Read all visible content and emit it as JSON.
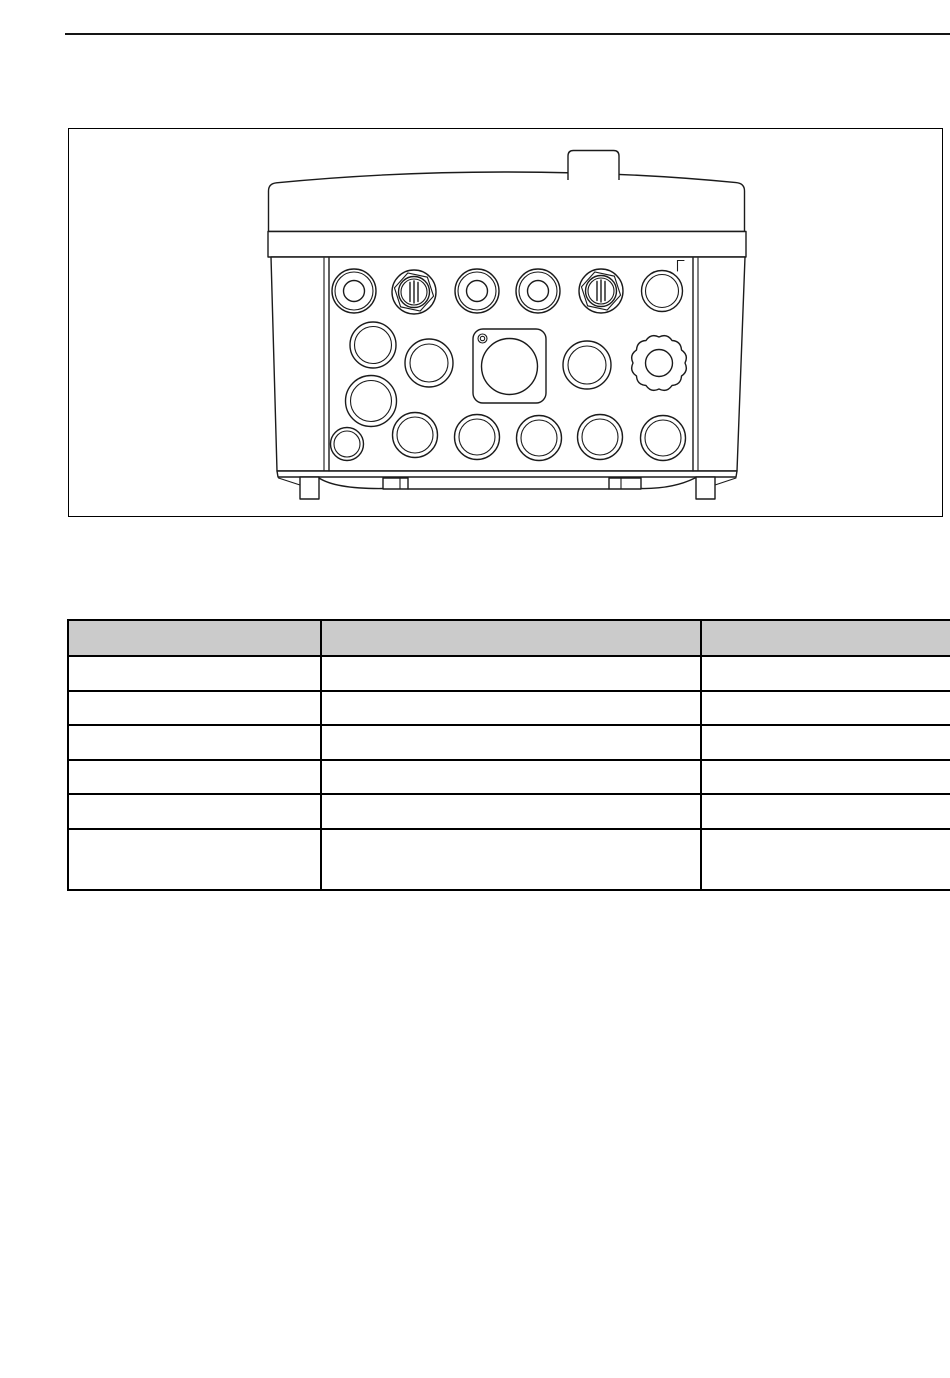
{
  "colors": {
    "accent_blue": "#b5d3e7",
    "accent_blue_light": "#c9ddec",
    "line": "#1b1b1b",
    "table_header_bg": "#cbcbcb"
  },
  "figure": {
    "drawing": "enclosure-bottom-view-technical-drawing",
    "highlighted_items": [
      "blue-cable-gland-1",
      "blue-connector-gland-1",
      "blue-cable-gland-2",
      "blue-cable-gland-3",
      "blue-connector-gland-2",
      "blue-rosette-gland"
    ]
  },
  "table": {
    "columns": [
      "",
      "",
      ""
    ],
    "rows": [
      [
        "",
        "",
        ""
      ],
      [
        "",
        "",
        ""
      ],
      [
        "",
        "",
        ""
      ],
      [
        "",
        "",
        ""
      ],
      [
        "",
        "",
        ""
      ],
      [
        "",
        "",
        ""
      ]
    ]
  }
}
